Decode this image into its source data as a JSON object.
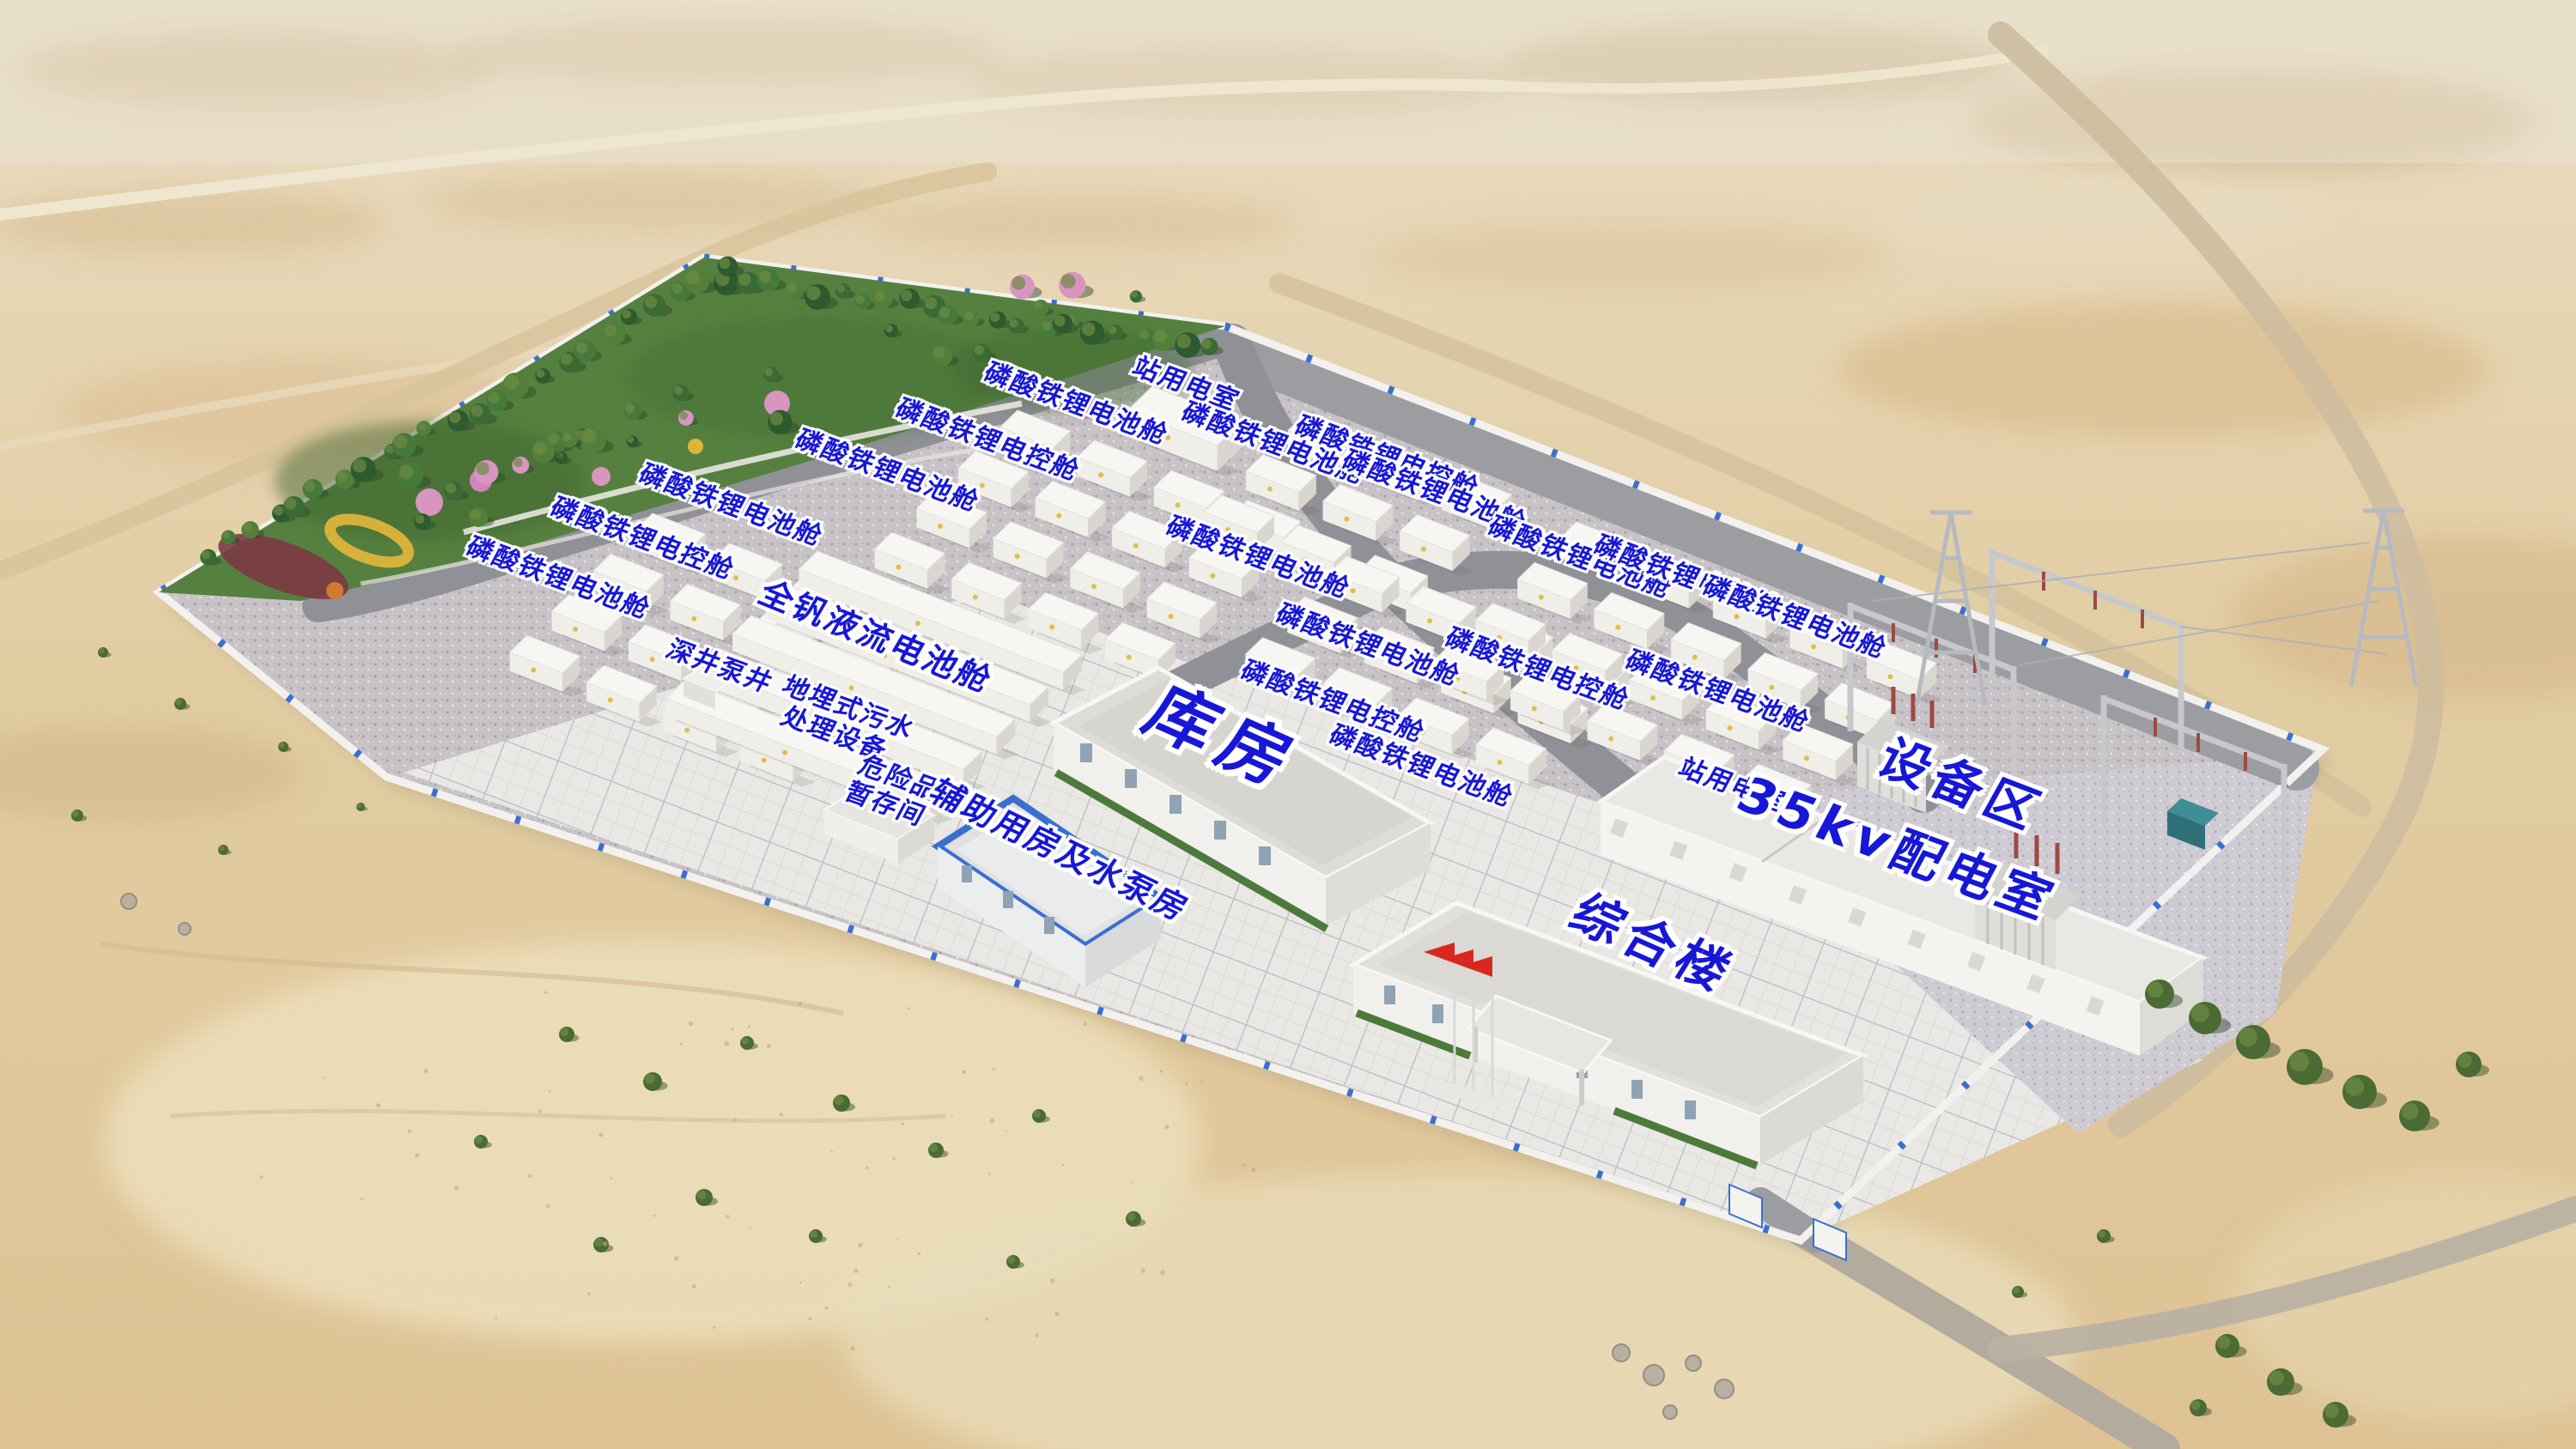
{
  "colors": {
    "label_blue": "#1717d8",
    "wall_trim_blue": "#3a6fd0",
    "flag_red": "#d8281e",
    "desert_sand": "#e0c89e",
    "yard_concrete": "#c8c3c7",
    "plaza_tile": "#eae8e4"
  },
  "labels": [
    {
      "text": "磷酸铁锂电池舱"
    },
    {
      "text": "站用电室"
    },
    {
      "text": "磷酸铁锂电控舱"
    },
    {
      "text": "磷酸铁锂电池舱"
    },
    {
      "text": "磷酸铁锂电池舱"
    },
    {
      "text": "磷酸铁锂电控舱"
    },
    {
      "text": "磷酸铁锂电池舱"
    },
    {
      "text": "磷酸铁锂电池舱"
    },
    {
      "text": "磷酸铁锂电控舱"
    },
    {
      "text": "磷酸铁锂电池舱"
    },
    {
      "text": "磷酸铁锂电池舱"
    },
    {
      "text": "磷酸铁锂电池舱"
    },
    {
      "text": "磷酸铁锂电控舱"
    },
    {
      "text": "磷酸铁锂电控舱"
    },
    {
      "text": "磷酸铁锂电池舱"
    },
    {
      "text": "磷酸铁锂电池舱"
    },
    {
      "text": "磷酸铁锂电控舱"
    },
    {
      "text": "磷酸铁锂电池舱"
    },
    {
      "text": "磷酸铁锂电池舱"
    },
    {
      "text": "全钒液流电池舱"
    },
    {
      "text": "深井泵井"
    },
    {
      "text": "地埋式污水\n处理设备"
    },
    {
      "text": "危险品\n暂存间"
    },
    {
      "text": "库房"
    },
    {
      "text": "辅助用房及水泵房"
    },
    {
      "text": "站用电室"
    },
    {
      "text": "35kv配电室"
    },
    {
      "text": "设备区"
    },
    {
      "text": "综合楼"
    }
  ]
}
